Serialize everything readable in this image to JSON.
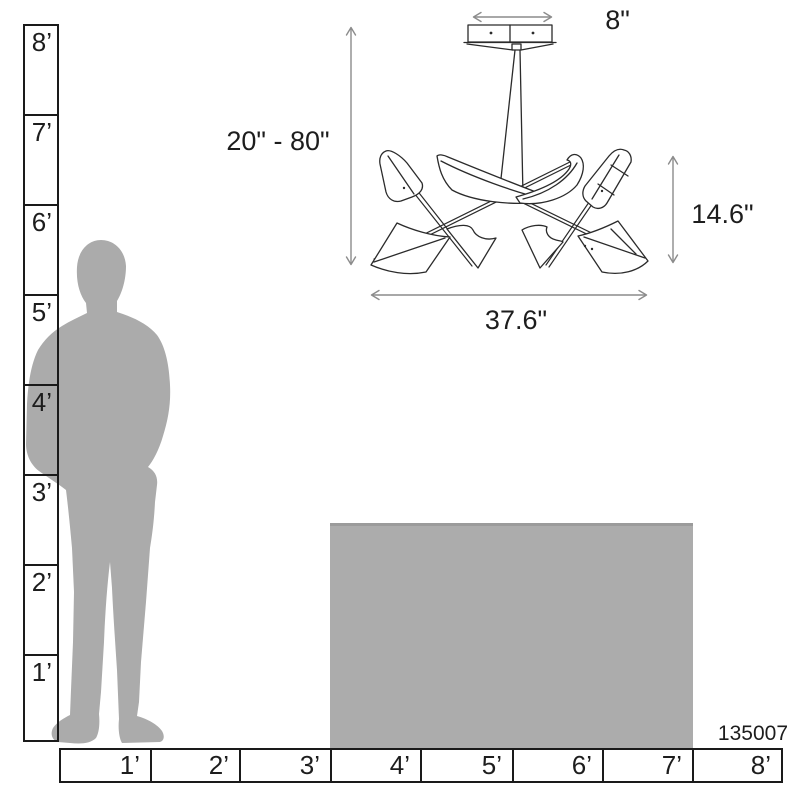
{
  "product_number": "135007",
  "fixture": {
    "dimensions": {
      "canopy_width": "8\"",
      "hanging_height_range": "20\" - 80\"",
      "body_height": "14.6\"",
      "body_width": "37.6\""
    }
  },
  "vertical_ruler": {
    "labels": [
      "8’",
      "7’",
      "6’",
      "5’",
      "4’",
      "3’",
      "2’",
      "1’"
    ]
  },
  "horizontal_ruler": {
    "labels": [
      "1’",
      "2’",
      "3’",
      "4’",
      "5’",
      "6’",
      "7’",
      "8’"
    ]
  },
  "colors": {
    "silhouette_gray": "#ABABAB",
    "table_gray": "#ACACAC",
    "table_top_edge": "#9B9B9B",
    "ruler_line": "#1A1A1A",
    "drawing_line": "#2B2B2B",
    "dimension_line": "#8C8C8C",
    "text": "#1D1D1D"
  }
}
